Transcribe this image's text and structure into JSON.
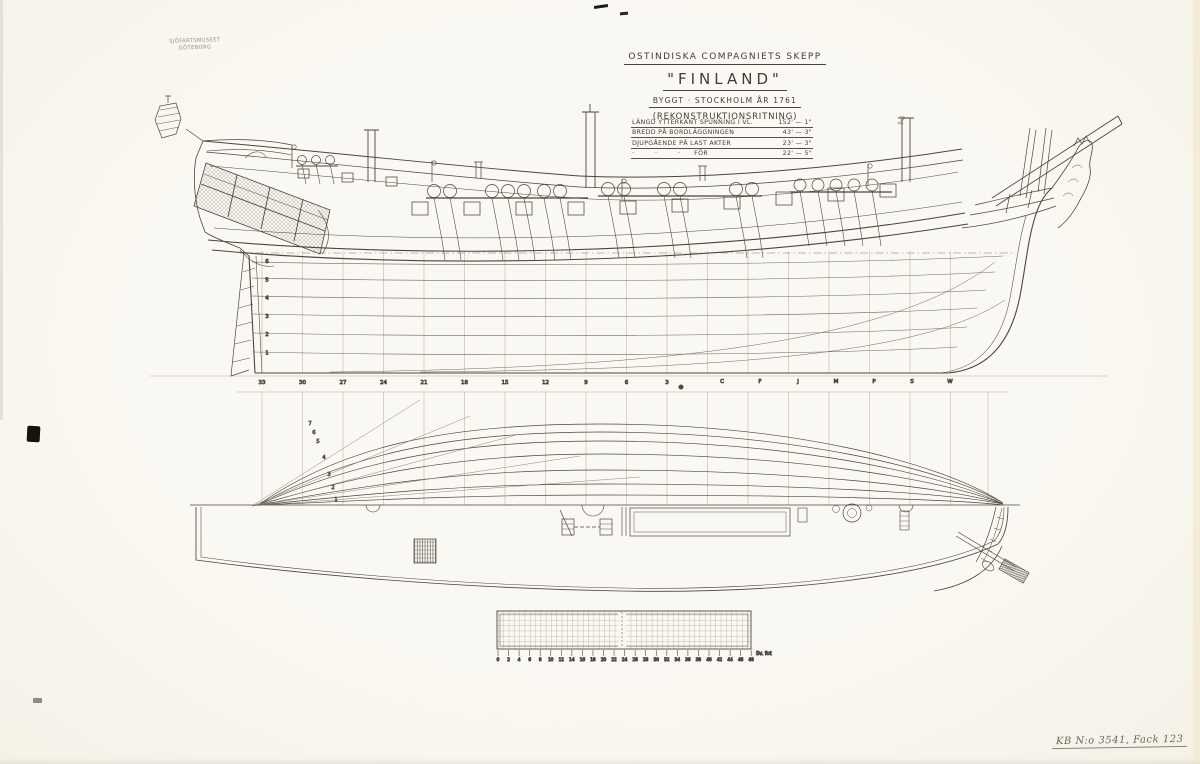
{
  "colors": {
    "paper": "#f9f6f0",
    "ink": "#4a463e",
    "pencil": "#aba496"
  },
  "stamp": {
    "line1": "SJÖFARTSMUSEET",
    "line2": "GÖTEBORG"
  },
  "title_block": {
    "company_line": "OSTINDISKA COMPAGNIETS SKEPP",
    "ship_name": "\"FINLAND\"",
    "built_line": "BYGGT · STOCKHOLM ÅR 1761",
    "type_line": "(REKONSTRUKTIONSRITNING)",
    "dimensions": [
      {
        "label": "LÄNGD YTTERKANT SPUNNING I VL.",
        "value": "152' — 1\""
      },
      {
        "label": "BREDD PÅ BORDLÄGGNINGEN",
        "value": "43' — 3\""
      },
      {
        "label": "DJUPGÅENDE PÅ LAST AKTER",
        "value": "23' — 3\""
      },
      {
        "label": "·         ·         ·      FÖR",
        "value": "22' — 5\""
      }
    ]
  },
  "annotations": {
    "pencil_mark": "2"
  },
  "profile_view": {
    "station_labels": [
      "33",
      "30",
      "27",
      "24",
      "21",
      "18",
      "15",
      "12",
      "9",
      "6",
      "3"
    ],
    "midship_symbol": "⊗",
    "bow_station_labels": [
      "C",
      "F",
      "J",
      "M",
      "P",
      "S",
      "W"
    ],
    "waterline_labels": [
      "6",
      "5",
      "4",
      "3",
      "2",
      "1"
    ]
  },
  "plan_view": {
    "waterline_labels": [
      "7",
      "6",
      "5",
      "4",
      "3",
      "2",
      "1"
    ]
  },
  "scale_bar": {
    "tick_labels": [
      "0",
      "2",
      "4",
      "6",
      "8",
      "10",
      "12",
      "14",
      "16",
      "18",
      "20",
      "22",
      "24",
      "26",
      "28",
      "30",
      "32",
      "34",
      "36",
      "38",
      "40",
      "42",
      "44",
      "46",
      "48"
    ],
    "unit_label": "Sv. fot"
  },
  "archive_note": "KB N:o 3541, Fack 123"
}
